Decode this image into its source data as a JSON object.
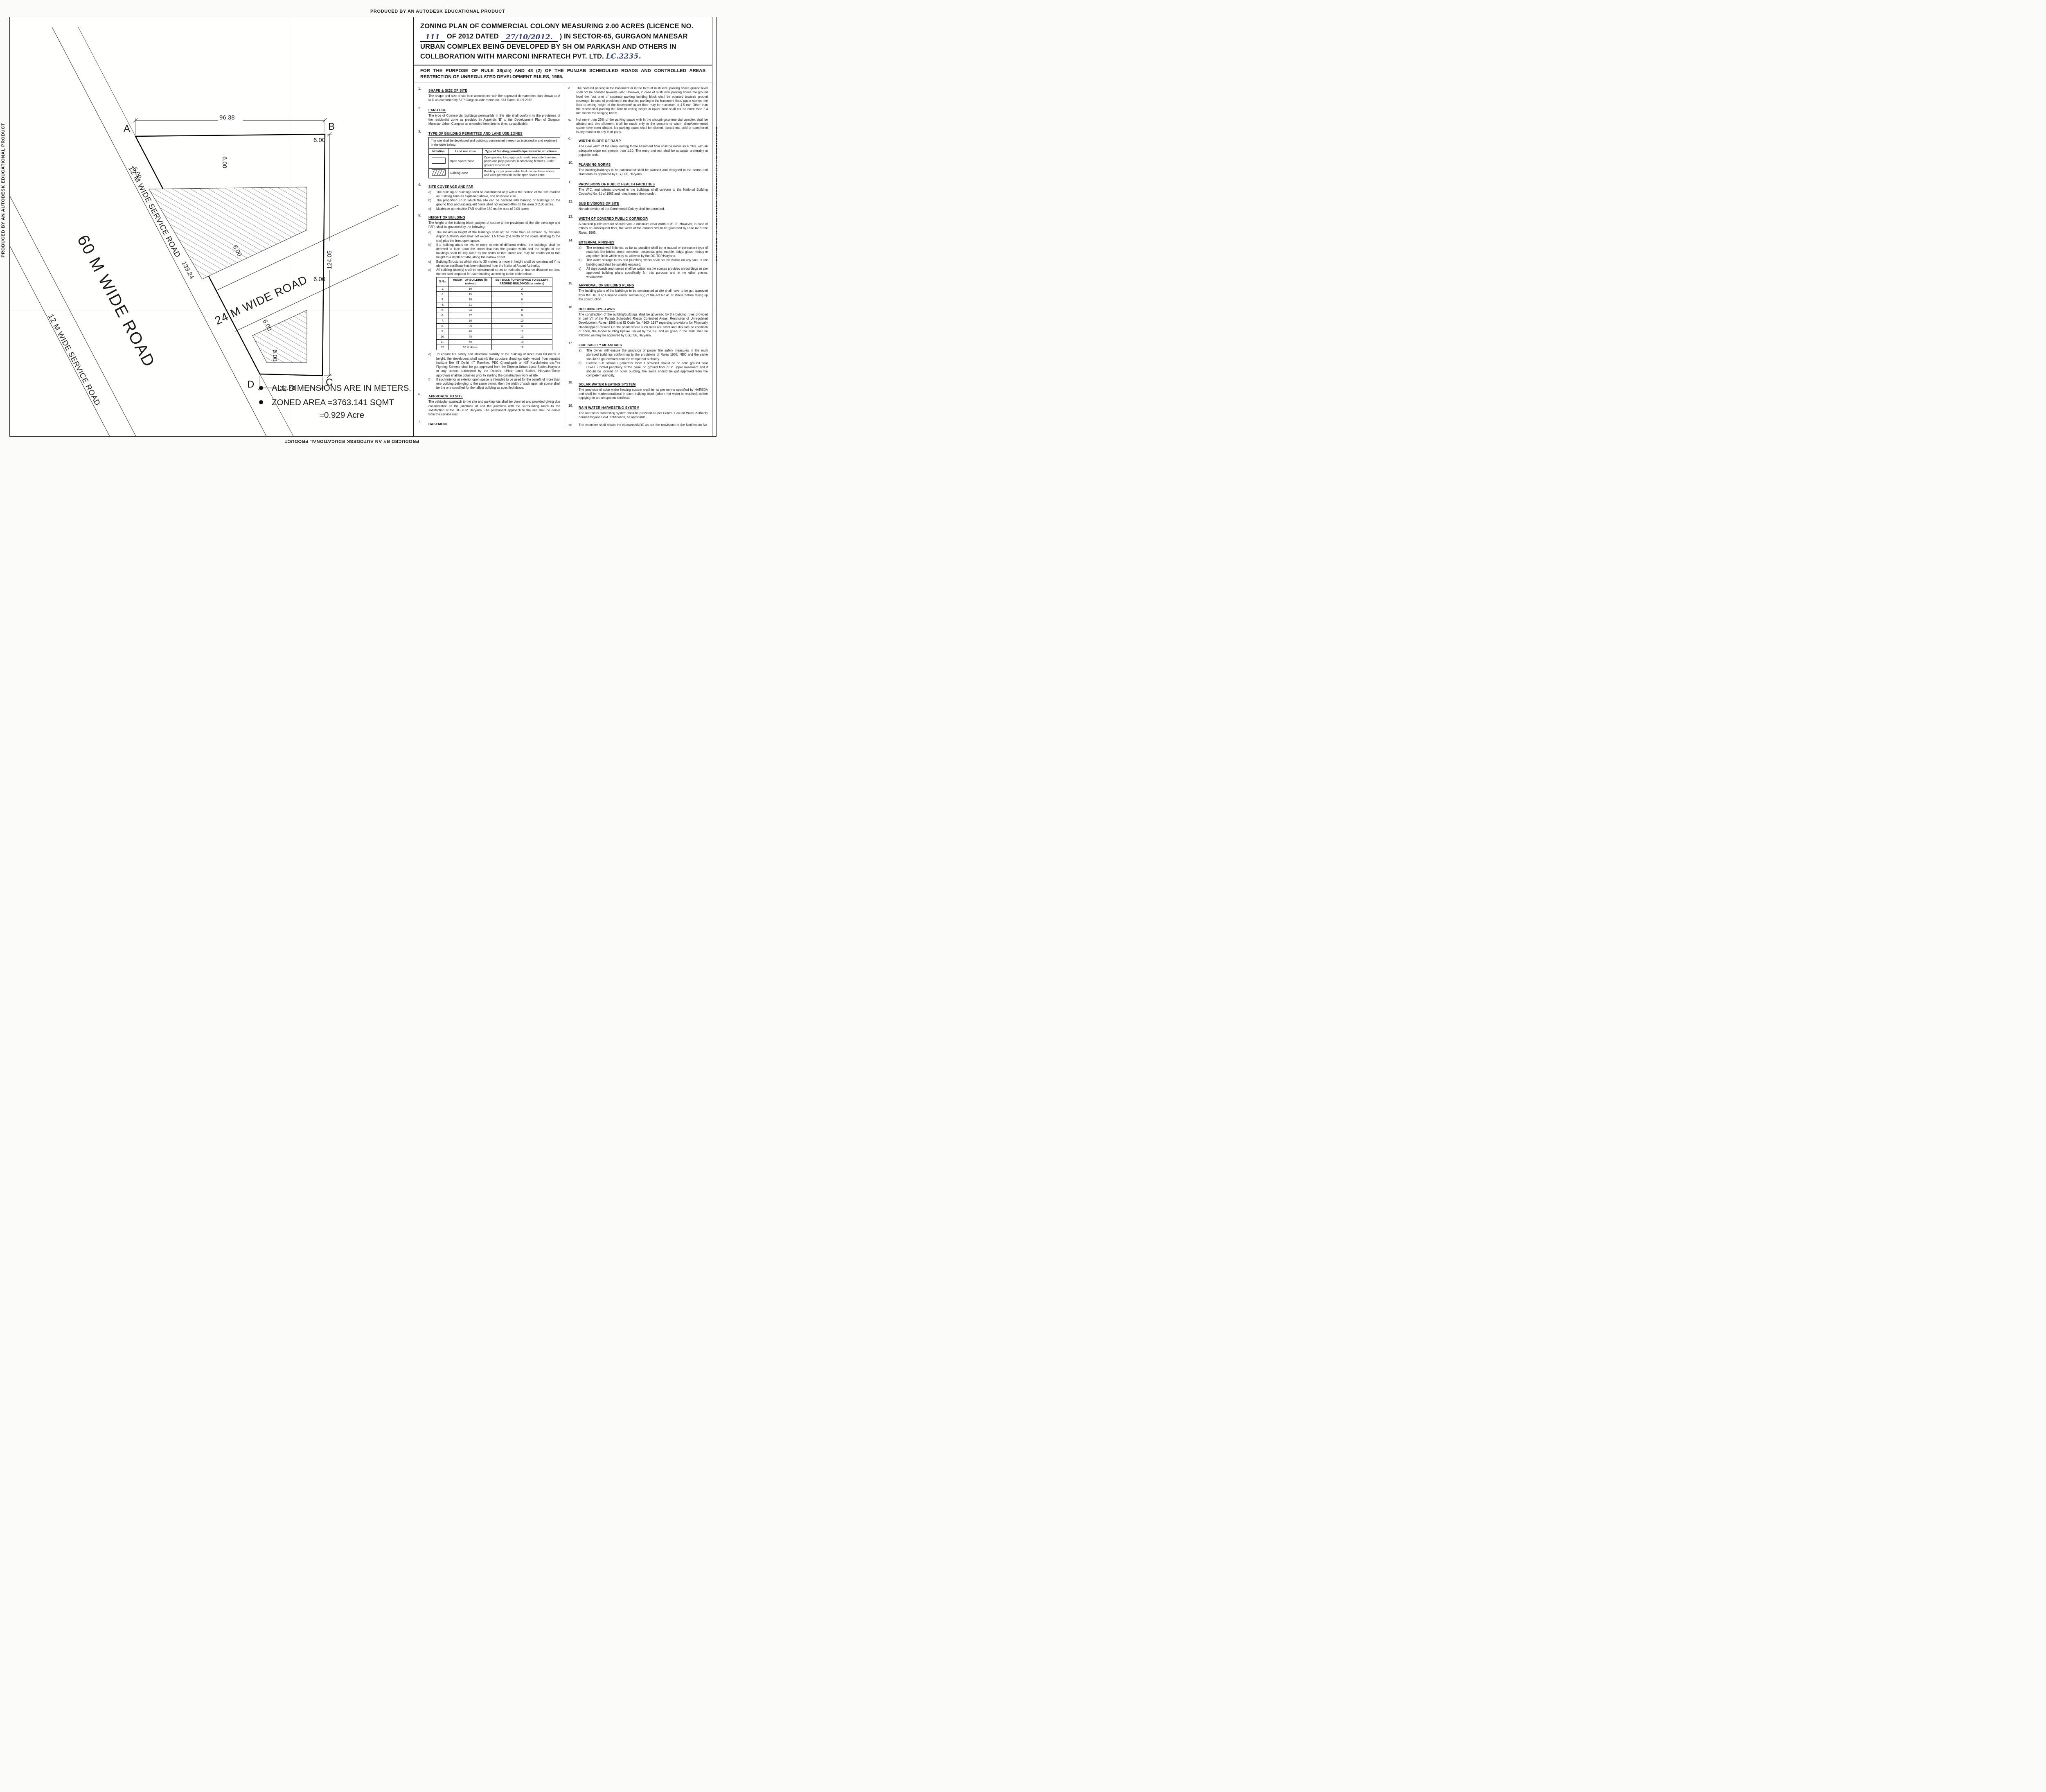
{
  "edge_text": "PRODUCED BY AN AUTODESK EDUCATIONAL PRODUCT",
  "title": {
    "seg1": "ZONING PLAN OF COMMERCIAL COLONY  MEASURING  2.00   ACRES (LICENCE NO.",
    "licence_no": "111",
    "seg2": "OF",
    "seg3": "2012 DATED",
    "dated": "27/10/2012.",
    "seg4": ") IN SECTOR-65, GURGAON MANESAR URBAN COMPLEX BEING DEVELOPED BY SH OM PARKASH AND OTHERS IN COLLBORATION WITH  MARCONI INFRATECH PVT. LTD.",
    "lc_no": "LC.2235."
  },
  "purpose": "FOR THE PURPOSE OF RULE 38(xlii) AND 48 (2) OF THE PUNJAB SCHEDULED ROADS AND CONTROLLED AREAS RESTRICTION OF UNREGULATED DEVELOPMENT RULES, 1965.",
  "left_col": {
    "c1": {
      "num": "1.",
      "title": "SHAPE & SIZE OF SITE",
      "body": "The shape and size of site is in accordance with the approved demarcation plan shown as A to D as confirmed by STP Gurgaon vide  memo no. 373 Dated 11.09.2012 ."
    },
    "c2": {
      "num": "2.",
      "title": "LAND USE",
      "body": "The type of Commercial buildings permissible in this site shall conform to the provisions of the residential zone as provided in Appendix 'B' to the Development Plan of Gurgaon Manesar Urban Complex as amended from time to time, as applicable."
    },
    "c3": {
      "num": "3.",
      "title": "TYPE OF BUILDING PERMITTED AND LAND USE ZONES",
      "intro": "The site shall be developed and buildings constructed thereon as indicated in and explained in the table below:",
      "table": {
        "headers": [
          "Notation",
          "Land use zone",
          "Type of Building permitted/permissible structures."
        ],
        "rows": [
          {
            "swatch": "open",
            "zone": "Open Space Zone",
            "desc": "Open parking lots, approach roads, roadside furniture, parks and  play  grounds, landscaping features, under ground services etc."
          },
          {
            "swatch": "hatch",
            "zone": "Building Zone",
            "desc": "Building as per permissible land use in clause above and uses permissible in the open space zone."
          }
        ]
      }
    },
    "c4": {
      "num": "4.",
      "title": "SITE COVERAGE AND FAR",
      "items": [
        {
          "m": "a)",
          "t": "The building or buildings shall be constructed only within the portion of the site marked as Building zone  as explained above, and no where else."
        },
        {
          "m": "b)",
          "t": "The proportion up to which the site can be covered with building or buildings on the ground floor and subsequent floors shall not exceed 40% on the area of 2.00 acres."
        },
        {
          "m": "c)",
          "t": "Maximum permissible FAR shall be 150 on the area of 2.00 acres."
        }
      ]
    },
    "c5": {
      "num": "5.",
      "title": "HEIGHT OF BUILDING",
      "intro": "The height of the building block, subject of course to the provisions of the site coverage and FAR, shall be governed by the following:-",
      "items": [
        {
          "m": "a)",
          "t": "The maximum height of the buildings shall not be more than as allowed by National Airport Authority and shall not  exceed 1.5 times (the width of the roads abutting to the site) plus  the front open space."
        },
        {
          "m": "b)",
          "t": "If a building abuts on two or more streets of different widths, the buildings shall be deemed to face upon the street that has the greater width and the height of the buildings shall be regulated by the width of that street and may be continued to this height to a depth of 24M, along the narrow street."
        },
        {
          "m": "c)",
          "t": "Building/Structures which rise to 30 meters or more in height shall be constructed if no objection certificate has been obtained from the National Airport Authority."
        },
        {
          "m": "d)",
          "t": "All building block(s) shall be constructed so as to maintain an interse distance not less the set back required for each building according to the table below:-"
        }
      ],
      "items2": [
        {
          "m": "e)",
          "t": "To ensure fire safety and structural stability of the building of more than 60 meter in height, the developers shall submit the structure drawings dully vetted from reputed institute like IIT Delhi, IIT Roorkee, PEC Chandigarh or NIT Kurukshetra etc.Fire Fighting Scheme shall be got approved from the Director,Urban Local Bodies,Haryana or any person authorized by the Director, Urban Local Bodies, Haryana.These approvals shall be obtained prior to starting the construction work at site."
        },
        {
          "m": "f)",
          "t": "If such interior or exterior open space is intended to be used for the benefit of more than one building belonging to the same owner, then the width of such open air space  shall be the one specified for the tallest building as specified above."
        }
      ]
    },
    "c6": {
      "num": "6.",
      "title": "APPROACH TO SITE",
      "body": "The vehicular approach to the site and parking lots shall be planned and provided giving due consideration to the junctions of and the junctions with the surrounding roads to the satisfaction of the DG,TCP, Haryana. The permanent approach to the site shall be derive from the service road."
    },
    "c7": {
      "num": "7.",
      "title": "BASEMENT",
      "body": "Four level basements within the building zone of the site provided it flushes with the  ground and is properly landscaped may be allowed. The basement may in addition to  parking could be utilized for generator  room,  lift room,  fire fighting  pumps,  water reservoir,  electric sub-station,  air conditioning plants and toilets/ utilities, if they satisfy the  public health requirements and for no other purposes. Area under stilts (only for parking) and basement shall not be counted towards FAR. Basement shall not be used for storage/commercial purposes but will be used only for parking and ancillary services of the main building and it is further stipulated that no other partitions of basement will be permissible for uses other than those specified above."
    },
    "c8": {
      "num": "8.",
      "title": "PARKING",
      "items": [
        {
          "m": "a.",
          "t": "Adequate parking spaces, covered, open or in the basement shall be provided for vehicles of users and occupiers, within the site."
        },
        {
          "m": "b.",
          "t": "At least 15% of the parking shall be at the street level."
        },
        {
          "m": "c.",
          "t": "The parking spaces for commercial building shall not be less than 1ECS for 50 sqm. of covered area on all floors. The area for parking per car shall be as under:"
        },
        {
          "m": "(i)",
          "t": "Basement   =  35 sq. mtrs."
        },
        {
          "m": "(ii)",
          "t": "Stilts          =  30 sq. mtrs."
        },
        {
          "m": "(iii)",
          "t": "Open         =  25 sq. mtrs."
        }
      ]
    }
  },
  "height_table": {
    "headers": [
      "S.No.",
      "HEIGHT OF BUILDING (in meters)",
      "SET BACK / OPEN SPACE TO BE LEFT AROUND BUILDINGS.(in meters)"
    ],
    "rows": [
      [
        "1.",
        "10",
        "3"
      ],
      [
        "2.",
        "15",
        "5"
      ],
      [
        "3.",
        "18",
        "6"
      ],
      [
        "4.",
        "21",
        "7"
      ],
      [
        "5.",
        "24",
        "8"
      ],
      [
        "6.",
        "27",
        "9"
      ],
      [
        "7.",
        "30",
        "10"
      ],
      [
        "8.",
        "35",
        "11"
      ],
      [
        "9.",
        "40",
        "12"
      ],
      [
        "10.",
        "45",
        "13"
      ],
      [
        "11.",
        "50",
        "14"
      ],
      [
        "12.",
        "55 & above",
        "16"
      ]
    ]
  },
  "right_col": {
    "d": {
      "m": "d.",
      "t": "The covered parking in the basement or in the form of multi level parking above ground level shall not be counted towards FAR. However, in case of multi level parking above the ground level the foot print of separate parking building block shall be counted towards ground coverage. In case of provision of mechanical parking in the basement floor/ upper stories, the floor to ceiling height of the basement/ upper  floor  may be maximum of 4.5 mtr. Other than the mechanical parking the floor to ceiling height in upper floor shall not be more than 2.4 mtr. below the hanging beam."
    },
    "e": {
      "m": "e.",
      "t": "Not more than 25% of the parking space with in the shopping/commercial complex shall be allotted and this allotment shall be made only to the persons to whom shop/commercial space have been allotted. No parking space shall be allotted, leased out, sold or transferred in any manner to any  third party."
    },
    "c9": {
      "num": "9.",
      "title": "WIDTH/ SLOPE OF RAMP",
      "body": "The clear width of the ramp leading to the basement floor shall be minimum 4 mtrs. with an adequate slope not steeper than 1:10. The entry and exit shall be separate preferably at opposite ends."
    },
    "c10": {
      "num": "10.",
      "title": "PLANNING NORMS",
      "body": "The building/buildings to be constructed shall be planned and designed to the norms and standards as approved by DG,TCP, Haryana."
    },
    "c11": {
      "num": "11.",
      "title": "PROVISIONS OF PUBLIC HEALTH FACILITIES",
      "body": "The W.C. and urinals provided in the buildings shall conform to the National Building Code/Act No. 41 of 1963 and rules framed there under."
    },
    "c12": {
      "num": "12.",
      "title": "SUB DIVISIONS OF SITE",
      "body": "No sub division of the Commercial Colony shall be permitted."
    },
    "c13": {
      "num": "13.",
      "title": "WIDTH OF COVERED PUBLIC CORRIDOR",
      "body": "A covered public corridor should have a minimum clear width of 8'- 3\".  However, in case of offices on subsequent floor, the width of the corridor would be governed by Rule 82 of the Rules, 1965."
    },
    "c14": {
      "num": "14.",
      "title": "EXTERNAL FINISHES",
      "items": [
        {
          "m": "a)",
          "t": "The external wall finishes, so far as possible shall be in natural or permanent type of materials like bricks, stone, concrete, terracotta, grits, marble,  chips, glass, metals or any other finish which may be allowed by the DG,TCP,Haryana."
        },
        {
          "m": "b)",
          "t": "The water storage tanks and plumbing works shall not be visible on any face of the building and shall be suitable encased."
        },
        {
          "m": "c)",
          "t": "All sign boards and names shall be written on the spaces provided on buildings as per approved building plans specifically for this purpose and at no other places, whatsoever."
        }
      ]
    },
    "c15": {
      "num": "15.",
      "title": "APPROVAL OF BUILDING PLANS",
      "body": "The building plans of the buildings to be constructed at site shall have to be got approved from the DG,TCP,  Haryana (under section 8(2) of the Act No.41 of 1963), before taking up the construction."
    },
    "c16": {
      "num": "16.",
      "title": "BUILDING BYE-LAWS",
      "body": "The construction of the building/buildings shall be governed by the building rules provided in part  VII of the Punjab Scheduled Roads Controlled Areas, Restriction of Unregulated Development Rules, 1965 and IS Code No. 4963- 1987 regarding provisions for Physically Handicapped Persons.On  the points where such rules are silent and stipulate no condition or norm, the model building byelaw issued by the ISI, and as given in the  NBC shall be followed as may be approved by DG,TCP, Haryana."
    },
    "c17": {
      "num": "17.",
      "title": "FIRE SAFETY MEASURES",
      "items": [
        {
          "m": "a)",
          "t": "The owner will ensure the provision of proper fire safety measures in the multi storeyed buildings conforming to the provisions of  Rules 1965/ NBC and the same should be got certified from the competent authority."
        },
        {
          "m": "b)",
          "t": "Electric Sub Station / generator room if provided should be on solid ground near DG/LT. Control periphery of the panel on ground floor or in upper basement and it should be located on outer building, the same should be got approved from the competent authority."
        }
      ]
    },
    "c18": {
      "num": "18.",
      "title": "SOLAR WATER HEATING SYSTEM",
      "body": "The provision of solar water heating system shall be as per norms specified by HAREDA  and shall be madeoperational in each building block (where hot water is required) before applying for an occupation certificate."
    },
    "c19": {
      "num": "19.",
      "title": "RAIN WATER HARVESTING SYSTEM",
      "body": "The rain water harvesting system shall be provided as per Central Ground Water Authority norms/Haryana Govt. notification, as applicable."
    },
    "c20": {
      "num": "20.",
      "body": "The colonizer shall obtain the clearance/NOC as per the provisions of the Notification No. S.O. 1533(E) Dated 14.9.2006 issued by Ministry of Environment and Forest, Government of India before starting the construction/ execution of development works at site."
    },
    "c21": {
      "num": "21.",
      "body": "The coloniser/owner shall use only Compact Fluorescent Lamp fittings for internal lighting as well as campus lighting."
    }
  },
  "drg": {
    "label": "DRG. No. DG,TCP",
    "no": "3500",
    "dated_label": "DATED",
    "date": "2-11-2012"
  },
  "signatories": [
    {
      "name": "(DEVENDRA NIMBOKAR)",
      "title": "DTP(HQ)"
    },
    {
      "name": "(JITENDER SIHAG)",
      "title": "STP(E & V)"
    },
    {
      "name": "(J. S. REDHU)",
      "title": "CTP(HR)"
    },
    {
      "name": "(T. C. GUPTA, IAS)",
      "title": "DG,TCP (HR)"
    }
  ],
  "plan": {
    "corner_a": "A",
    "corner_b": "B",
    "corner_c": "C",
    "corner_d": "D",
    "dim_top": "96.38",
    "dim_right": "124.05",
    "dim_bottom": "32.78",
    "dim_road": "139.24",
    "setback": "6.00",
    "road_24": "24 M WIDE ROAD",
    "road_60": "60 M WIDE ROAD",
    "service_road_upper": "12 M WIDE SERVICE ROAD",
    "service_road_lower": "12 M WIDE SERVICE ROAD",
    "notes": {
      "n1": "ALL DIMENSIONS ARE IN METERS.",
      "n2": "ZONED AREA =3763.141 SQMT",
      "n3": "=0.929 Acre"
    }
  }
}
